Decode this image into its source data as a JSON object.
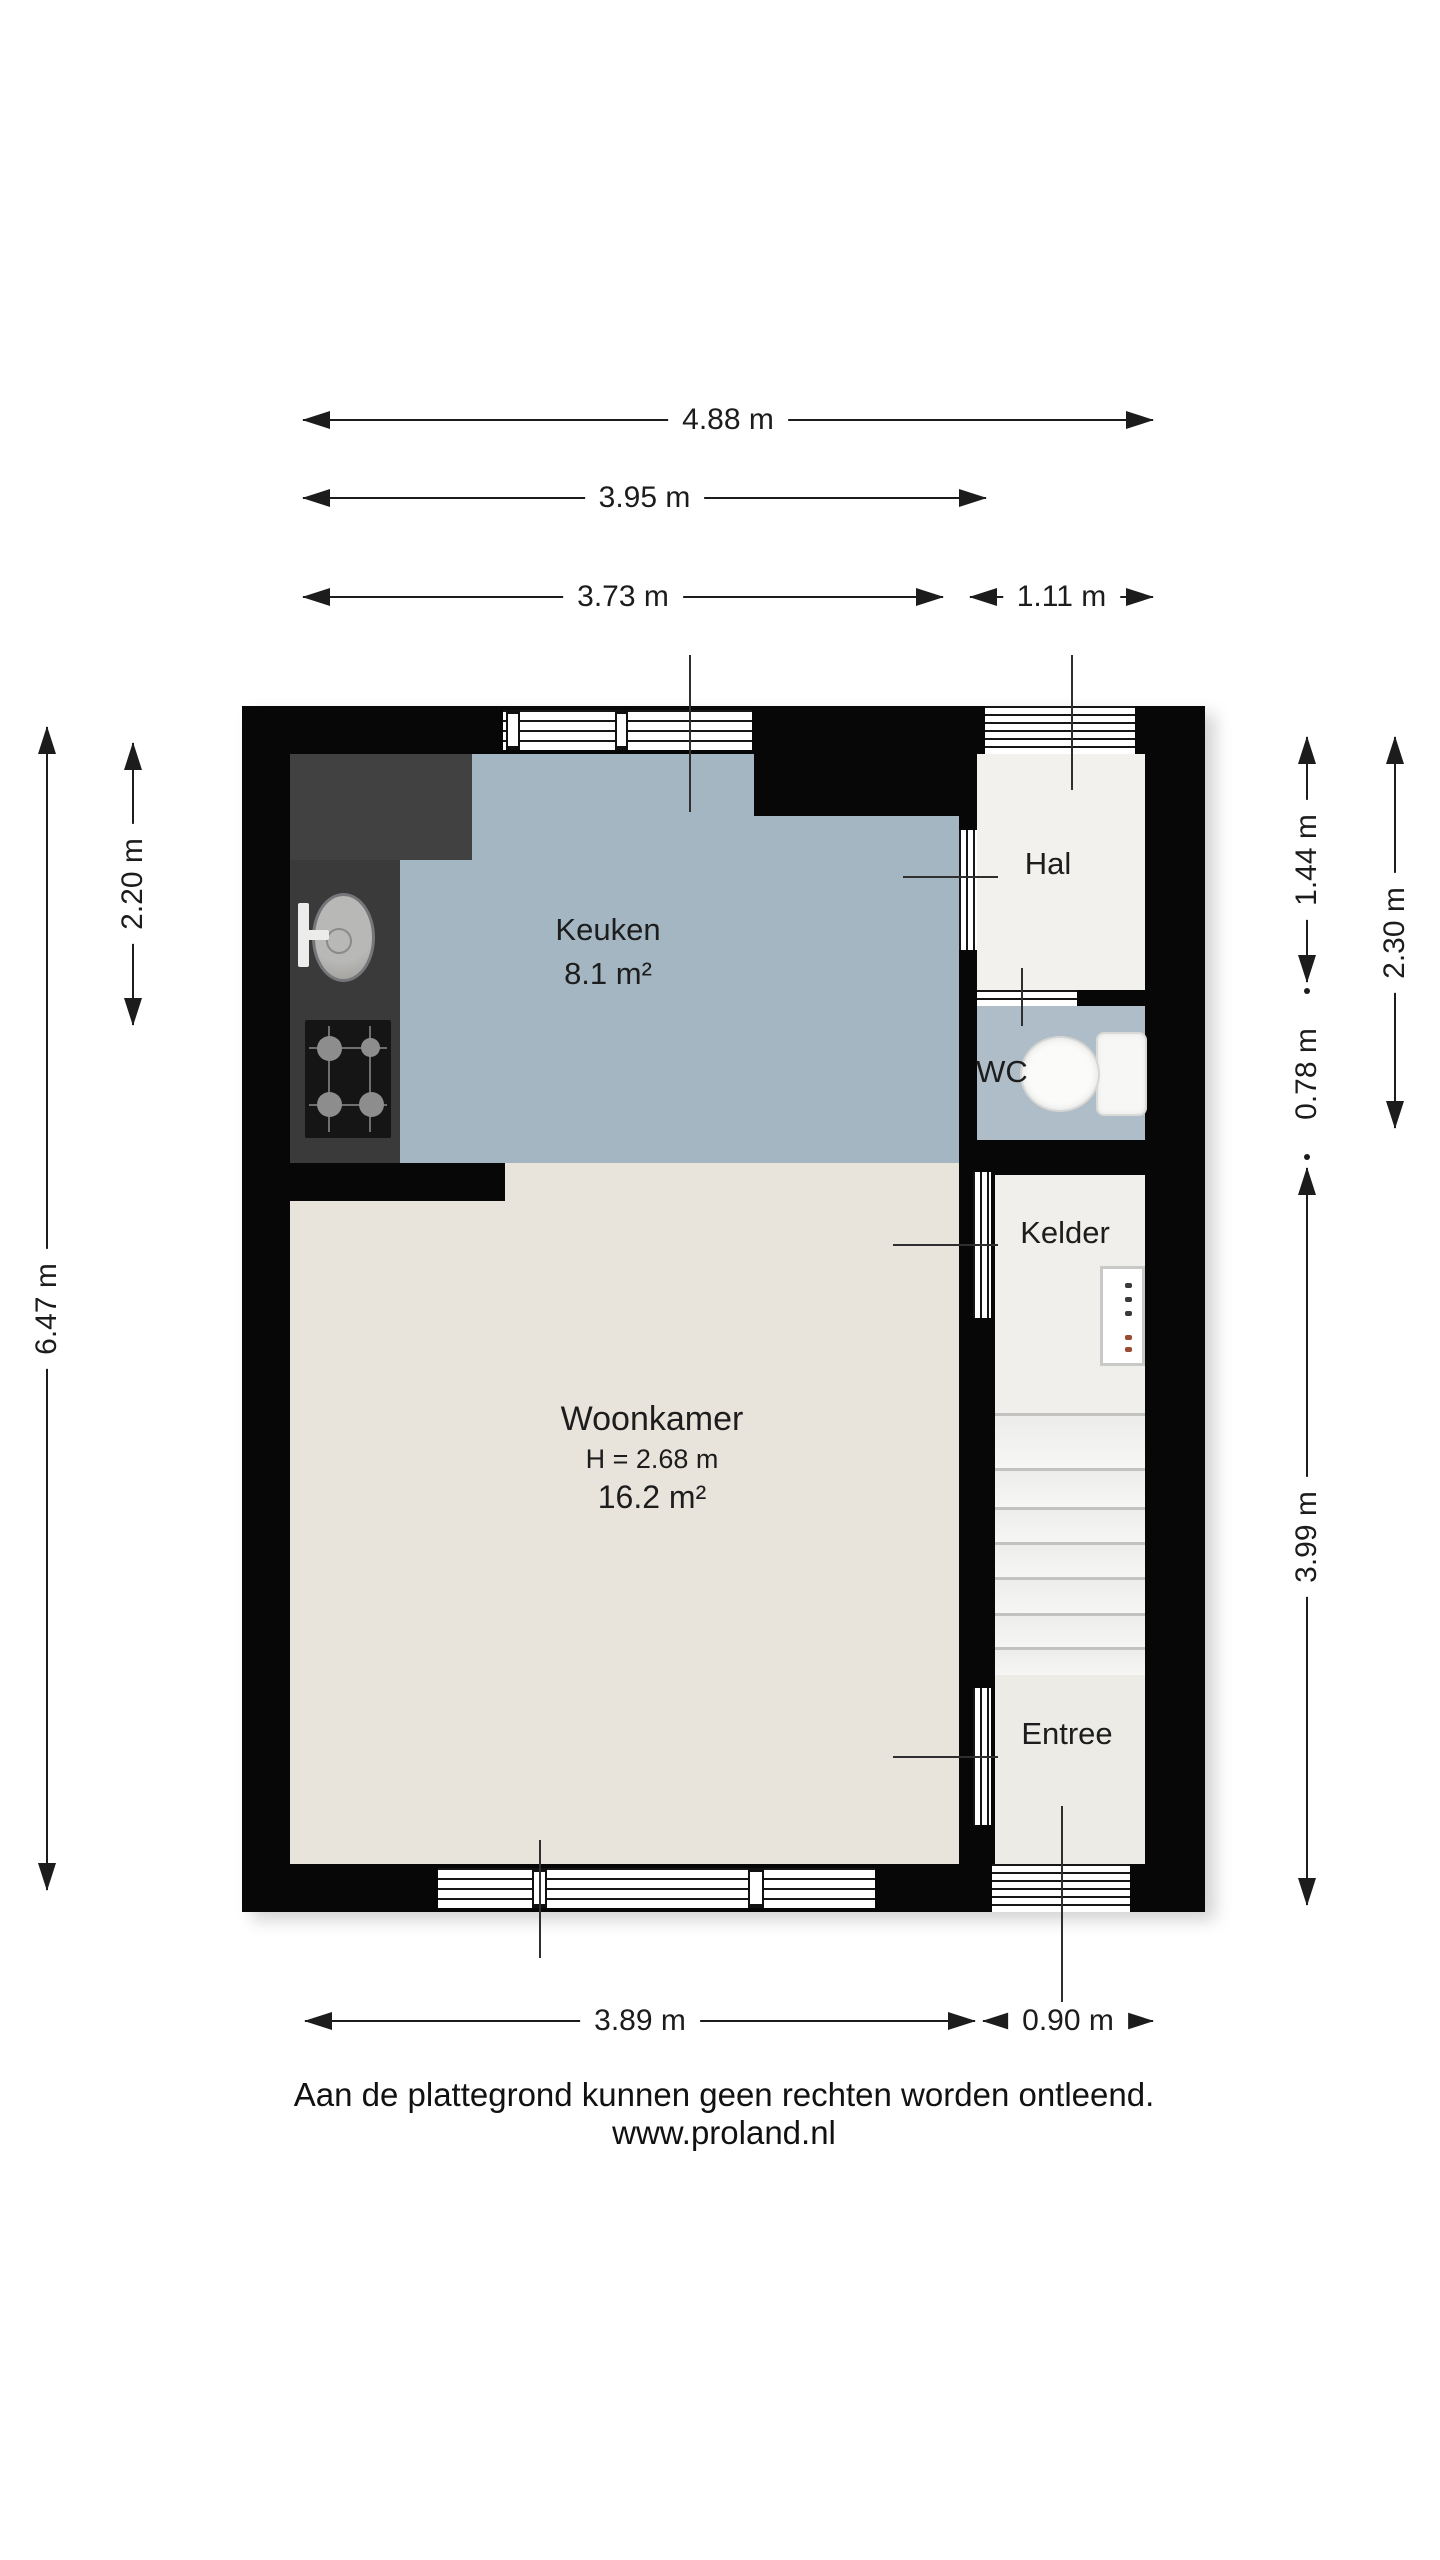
{
  "plan": {
    "rooms": {
      "keuken": {
        "name": "Keuken",
        "area": "8.1 m²"
      },
      "hal": {
        "name": "Hal"
      },
      "wc": {
        "name": "WC"
      },
      "kelder": {
        "name": "Kelder"
      },
      "woonkamer": {
        "name": "Woonkamer",
        "height": "H = 2.68 m",
        "area": "16.2 m²"
      },
      "entree": {
        "name": "Entree"
      }
    },
    "fixtures": {
      "sink": "kitchen-sink-icon",
      "stove": "gas-hob-icon",
      "toilet": "toilet-icon",
      "stairs": "staircase-icon",
      "meter_cabinet": "meter-cabinet-icon"
    }
  },
  "dimensions": {
    "top": [
      {
        "label": "4.88 m"
      },
      {
        "label": "3.95 m"
      },
      {
        "label": "3.73 m"
      },
      {
        "label": "1.11 m"
      }
    ],
    "left": [
      {
        "label": "6.47 m"
      },
      {
        "label": "2.20 m"
      }
    ],
    "right": [
      {
        "label": "1.44 m"
      },
      {
        "label": "2.30 m"
      },
      {
        "label": "0.78 m"
      },
      {
        "label": "3.99 m"
      }
    ],
    "bottom": [
      {
        "label": "3.89 m"
      },
      {
        "label": "0.90 m"
      }
    ]
  },
  "footer": {
    "disclaimer": "Aan de plattegrond kunnen geen rechten worden ontleend.",
    "website": "www.proland.nl"
  },
  "colors": {
    "wall": "#070707",
    "keuken_floor": "#a4b6c2",
    "wc_floor": "#aebdc7",
    "woonkamer_floor": "#e8e4db",
    "hal_floor": "#f2f1ed",
    "kelder_floor": "#f0efec",
    "entree_floor": "#ecebe6",
    "counter": "#3a3a3a",
    "cabinet": "#414141",
    "stove": "#151515",
    "dimension": "#1c1c1c",
    "label_text": "#1d1d1d"
  }
}
